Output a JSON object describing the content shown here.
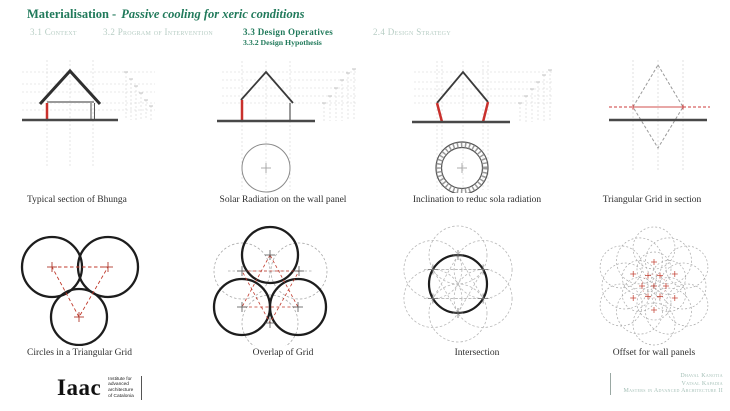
{
  "header": {
    "title_main": "Materialisation -",
    "title_italic": "Passive cooling for xeric conditions",
    "tabs": [
      {
        "label": "3.1 Context"
      },
      {
        "label": "3.2 Program of Intervention"
      },
      {
        "label": "3.3 Design Operatives",
        "sublabel": "3.3.2 Design Hypothesis"
      },
      {
        "label": "2.4 Design Strategy"
      }
    ]
  },
  "captions": [
    "Typical section of Bhunga",
    "Solar Radiation on the wall panel",
    "Inclination to reduc sola radiation",
    "Triangular Grid in section",
    "Circles in a Triangular Grid",
    "Overlap of Grid",
    "Intersection",
    "Offset for wall panels"
  ],
  "footer": {
    "logo_text": "Iaac",
    "institute_lines": [
      "Institute for",
      "advanced",
      "architecture",
      "of Catalonia"
    ],
    "credits": [
      "Dhaval Kanotia",
      "Vatsal Kapadia",
      "Masters in Advanced Architecture II"
    ]
  },
  "colors": {
    "accent_green": "#217a5b",
    "muted_tab": "#b7cdc4",
    "highlight_red": "#c9302c",
    "grid_gray": "#cfcfcf",
    "ink": "#3a3a3a"
  }
}
